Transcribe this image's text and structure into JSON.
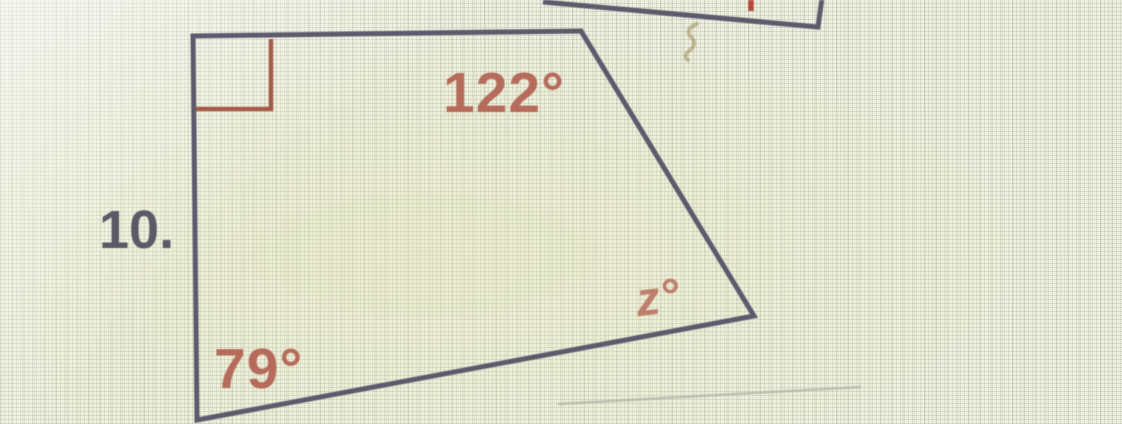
{
  "page": {
    "kind": "photographed geometry worksheet problem",
    "problem_number": "10."
  },
  "diagram": {
    "shape": "quadrilateral",
    "task": "find unknown angle z",
    "angles": {
      "top_left": {
        "label": "right-angle marker",
        "value_deg": 90
      },
      "top_right_interior": {
        "label": "122°",
        "value_deg": 122
      },
      "bottom_left": {
        "label": "79°",
        "value_deg": 79
      },
      "right": {
        "label": "z°",
        "value_deg": null
      }
    },
    "labels": {
      "top_angle": "122°",
      "bottom_left_angle": "79°",
      "right_angle_unknown": "z°"
    }
  },
  "adjacent_figure_fragment": {
    "note": "bottom sliver of previous problem's figure cropped at top edge",
    "stray_mark": "faint pencil squiggle (?)"
  },
  "colors": {
    "paper": "#eaebd8",
    "figure_ink": "#5b5b6d",
    "angle_label_ink": "#b05a4a",
    "unknown_label_ink": "#b36250",
    "right_angle_marker_ink": "#a35c49",
    "problem_number_ink": "#4e4e5f",
    "red_fragment_ink": "#b44a3c",
    "pencil_mark": "#b2b5a9",
    "squiggle_ink": "#97854f"
  }
}
